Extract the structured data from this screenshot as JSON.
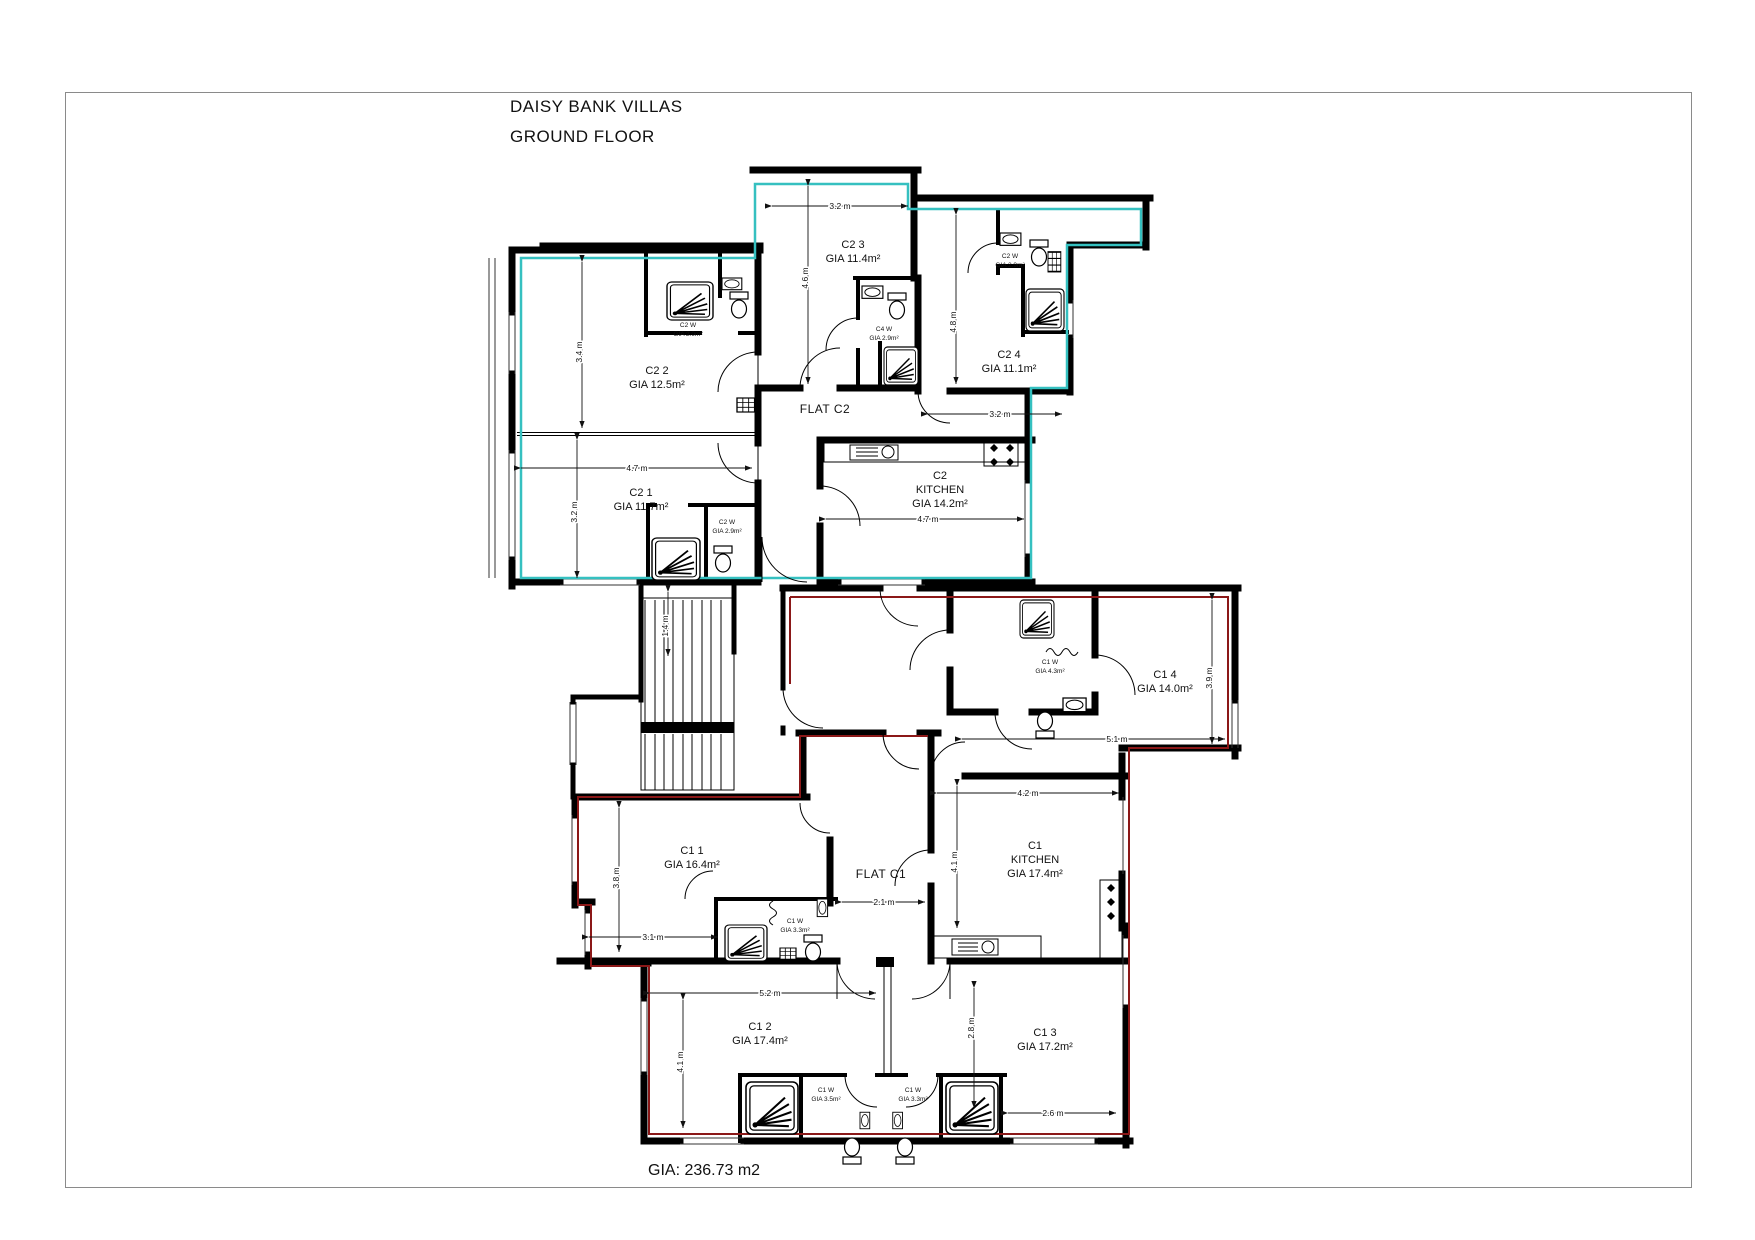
{
  "title": {
    "project": "DAISY BANK VILLAS",
    "floor": "GROUND FLOOR"
  },
  "footer": {
    "total_gia": "GIA: 236.73 m2"
  },
  "flats": {
    "c2": {
      "label": "FLAT C2",
      "outline_color": "#35c0c0"
    },
    "c1": {
      "label": "FLAT C1",
      "outline_color": "#8b1818"
    }
  },
  "rooms": [
    {
      "id": "c2-2",
      "name": "C2 2",
      "area": "GIA 12.5m²"
    },
    {
      "id": "c2-3",
      "name": "C2 3",
      "area": "GIA 11.4m²"
    },
    {
      "id": "c2-4",
      "name": "C2 4",
      "area": "GIA 11.1m²"
    },
    {
      "id": "c2-1",
      "name": "C2 1",
      "area": "GIA 11.7m²"
    },
    {
      "id": "c2-kitchen",
      "name": "C2",
      "line2": "KITCHEN",
      "area": "GIA 14.2m²"
    },
    {
      "id": "c1-4",
      "name": "C1 4",
      "area": "GIA 14.0m²"
    },
    {
      "id": "c1-1",
      "name": "C1 1",
      "area": "GIA 16.4m²"
    },
    {
      "id": "c1-kitchen",
      "name": "C1",
      "line2": "KITCHEN",
      "area": "GIA 17.4m²"
    },
    {
      "id": "c1-2",
      "name": "C1 2",
      "area": "GIA 17.4m²"
    },
    {
      "id": "c1-3",
      "name": "C1 3",
      "area": "GIA 17.2m²"
    }
  ],
  "wcs": [
    {
      "id": "c2-2-ensuite",
      "name": "C2 W",
      "area": "GIA 2.9m²"
    },
    {
      "id": "c2-3-ensuite",
      "name": "C4 W",
      "area": "GIA 2.9m²"
    },
    {
      "id": "c2-4-ensuite",
      "name": "C2 W",
      "area": "GIA 2.9m²"
    },
    {
      "id": "c2-1-ensuite",
      "name": "C2 W",
      "area": "GIA 2.9m²"
    },
    {
      "id": "c1-4-bathroom",
      "name": "C1 W",
      "area": "GIA 4.3m²"
    },
    {
      "id": "c1-1-ensuite",
      "name": "C1 W",
      "area": "GIA 3.3m²"
    },
    {
      "id": "c1-2-ensuite",
      "name": "C1 W",
      "area": "GIA 3.5m²"
    },
    {
      "id": "c1-3-ensuite",
      "name": "C1 W",
      "area": "GIA 3.3m²"
    }
  ],
  "dims": [
    {
      "id": "c2-3-width",
      "value": "3.2 m"
    },
    {
      "id": "c2-3-height",
      "value": "4.6 m"
    },
    {
      "id": "c2-2-height",
      "value": "3.4 m"
    },
    {
      "id": "c2-4-height",
      "value": "4.8 m"
    },
    {
      "id": "c2-4-width",
      "value": "3.2 m"
    },
    {
      "id": "c2-1-width",
      "value": "4.7 m"
    },
    {
      "id": "c2-1-height",
      "value": "3.2 m"
    },
    {
      "id": "c2-kitchen-width",
      "value": "4.7 m"
    },
    {
      "id": "landing",
      "value": "1.4 m"
    },
    {
      "id": "c1-4-height",
      "value": "3.9 m"
    },
    {
      "id": "c1-4-width",
      "value": "5.1 m"
    },
    {
      "id": "c1-kitchen-width",
      "value": "4.2 m"
    },
    {
      "id": "c1-kitchen-height",
      "value": "4.1 m"
    },
    {
      "id": "c1-hall-width",
      "value": "2.1 m"
    },
    {
      "id": "c1-1-height",
      "value": "3.8 m"
    },
    {
      "id": "c1-1-width",
      "value": "3.1 m"
    },
    {
      "id": "c1-2-width",
      "value": "5.2 m"
    },
    {
      "id": "c1-2-height",
      "value": "4.1 m"
    },
    {
      "id": "c1-3-height",
      "value": "2.8 m"
    },
    {
      "id": "c1-3-width",
      "value": "2.6 m"
    }
  ]
}
